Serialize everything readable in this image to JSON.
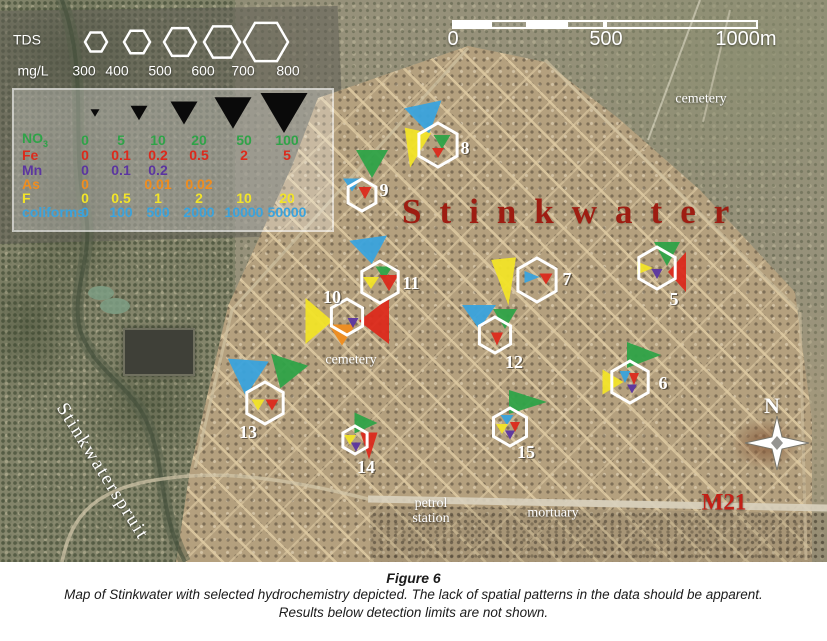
{
  "figure": {
    "label": "Figure 6",
    "caption1": "Map of Stinkwater with selected hydrochemistry depicted. The lack of spatial patterns in the data should be apparent.",
    "caption2": "Results below detection limits are not shown."
  },
  "map": {
    "title": "Stinkwater",
    "title_color": "#9e1d12",
    "place_labels": [
      {
        "name": "label-cemetery-north",
        "text": "cemetery",
        "x": 701,
        "y": 99,
        "size": 14
      },
      {
        "name": "label-cemetery-central",
        "text": "cemetery",
        "x": 351,
        "y": 360,
        "size": 14
      },
      {
        "name": "label-petrol-station",
        "text": "petrol\nstation",
        "x": 431,
        "y": 511,
        "size": 14
      },
      {
        "name": "label-mortuary",
        "text": "mortuary",
        "x": 553,
        "y": 513,
        "size": 14
      },
      {
        "name": "label-road-m21",
        "text": "M21",
        "x": 724,
        "y": 503,
        "size": 23,
        "color": "#c32017",
        "bold": true
      },
      {
        "name": "label-stinkwaterspruit",
        "text": "Stinkwaterspruit",
        "x": 102,
        "y": 472,
        "size": 19,
        "rot": 58,
        "spacing": 2
      },
      {
        "name": "label-compass-n",
        "text": "N",
        "x": 772,
        "y": 406,
        "size": 22,
        "bold": true
      }
    ],
    "compass": {
      "x": 777,
      "y": 443
    }
  },
  "params": {
    "NO3": "#2fa348",
    "Fe": "#dc2a1c",
    "Mn": "#5b35a0",
    "As": "#ef8d1f",
    "F": "#f2e428",
    "coliforms": "#3aa3dd"
  },
  "tds_legend": {
    "title": "TDS",
    "unit": "mg/L",
    "values": [
      "300",
      "400",
      "500",
      "600",
      "700",
      "800"
    ],
    "value_x": [
      84,
      117,
      160,
      203,
      243,
      288
    ],
    "label_y": 71,
    "hex_y": 42,
    "hexes": [
      {
        "x": 96,
        "r": 11
      },
      {
        "x": 137,
        "r": 13
      },
      {
        "x": 180,
        "r": 16
      },
      {
        "x": 222,
        "r": 18
      },
      {
        "x": 266,
        "r": 22
      }
    ]
  },
  "param_legend": {
    "tri_y": 113,
    "triangles": [
      {
        "x": 95,
        "w": 9
      },
      {
        "x": 139,
        "w": 17
      },
      {
        "x": 184,
        "w": 27
      },
      {
        "x": 233,
        "w": 37
      },
      {
        "x": 284,
        "w": 47
      }
    ],
    "col_x": [
      85,
      121,
      158,
      199,
      244,
      287
    ],
    "label_x": 22,
    "rows": [
      {
        "name": "NO3",
        "label": "NO",
        "sub": "3",
        "y": 140,
        "values": [
          "0",
          "5",
          "10",
          "20",
          "50",
          "100"
        ]
      },
      {
        "name": "Fe",
        "label": "Fe",
        "sub": "",
        "y": 155,
        "values": [
          "0",
          "0.1",
          "0.2",
          "0.5",
          "2",
          "5"
        ]
      },
      {
        "name": "Mn",
        "label": "Mn",
        "sub": "",
        "y": 170,
        "values": [
          "0",
          "0.1",
          "0.2",
          "",
          "",
          ""
        ]
      },
      {
        "name": "As",
        "label": "As",
        "sub": "",
        "y": 184,
        "values": [
          "0",
          "",
          "0.01",
          "0.02",
          "",
          ""
        ]
      },
      {
        "name": "F",
        "label": "F",
        "sub": "",
        "y": 198,
        "values": [
          "0",
          "0.5",
          "1",
          "2",
          "10",
          "20"
        ]
      },
      {
        "name": "coliforms",
        "label": "coliforms",
        "sub": "",
        "y": 212,
        "values": [
          "0",
          "100",
          "500",
          "2000",
          "10000",
          "50000"
        ]
      }
    ]
  },
  "scalebar": {
    "x": 452,
    "y": 20,
    "h": 9,
    "segments": [
      {
        "w": 38,
        "filled": true
      },
      {
        "w": 38,
        "filled": false
      },
      {
        "w": 38,
        "filled": true
      },
      {
        "w": 39,
        "filled": false
      },
      {
        "w": 153,
        "filled": false
      }
    ],
    "labels": [
      {
        "text": "0",
        "x": 453
      },
      {
        "text": "500",
        "x": 606
      },
      {
        "text": "1000m",
        "x": 746
      }
    ],
    "label_y": 40
  },
  "sites": [
    {
      "id": "5",
      "x": 657,
      "y": 268,
      "r": 21,
      "num": {
        "dx": 17,
        "dy": 31
      },
      "triangles": [
        {
          "p": "NO3",
          "dir": "down",
          "w": 26,
          "h": 24,
          "dx": 10,
          "dy": -14,
          "rot": 0
        },
        {
          "p": "Fe",
          "dir": "left",
          "w": 18,
          "h": 40,
          "dx": 20,
          "dy": 4,
          "rot": 0
        },
        {
          "p": "F",
          "dir": "right",
          "w": 16,
          "h": 13,
          "dx": -12,
          "dy": 0,
          "rot": 0
        },
        {
          "p": "Mn",
          "dir": "down",
          "w": 11,
          "h": 10,
          "dx": 0,
          "dy": 6,
          "rot": 0
        }
      ]
    },
    {
      "id": "6",
      "x": 630,
      "y": 382,
      "r": 21,
      "num": {
        "dx": 33,
        "dy": 1
      },
      "triangles": [
        {
          "p": "NO3",
          "dir": "right",
          "w": 34,
          "h": 26,
          "dx": 14,
          "dy": -27,
          "rot": 0
        },
        {
          "p": "F",
          "dir": "right",
          "w": 21,
          "h": 25,
          "dx": -17,
          "dy": 0,
          "rot": 0
        },
        {
          "p": "coliforms",
          "dir": "down",
          "w": 11,
          "h": 12,
          "dx": -5,
          "dy": -5,
          "rot": 0
        },
        {
          "p": "Fe",
          "dir": "down",
          "w": 10,
          "h": 12,
          "dx": 4,
          "dy": -3,
          "rot": 0
        },
        {
          "p": "Mn",
          "dir": "down",
          "w": 10,
          "h": 9,
          "dx": 2,
          "dy": 7,
          "rot": 0
        }
      ]
    },
    {
      "id": "7",
      "x": 537,
      "y": 280,
      "r": 22,
      "num": {
        "dx": 30,
        "dy": -1
      },
      "triangles": [
        {
          "p": "F",
          "dir": "down",
          "w": 25,
          "h": 47,
          "dx": -31,
          "dy": 2,
          "rot": -6
        },
        {
          "p": "coliforms",
          "dir": "right",
          "w": 15,
          "h": 12,
          "dx": -5,
          "dy": -3,
          "rot": 0
        },
        {
          "p": "Fe",
          "dir": "down",
          "w": 13,
          "h": 11,
          "dx": 9,
          "dy": -1,
          "rot": 0
        }
      ]
    },
    {
      "id": "8",
      "x": 438,
      "y": 145,
      "r": 22,
      "num": {
        "dx": 27,
        "dy": 3
      },
      "triangles": [
        {
          "p": "coliforms",
          "dir": "down",
          "w": 38,
          "h": 30,
          "dx": -12,
          "dy": -26,
          "rot": -12
        },
        {
          "p": "F",
          "dir": "down",
          "w": 27,
          "h": 38,
          "dx": -24,
          "dy": 4,
          "rot": 12
        },
        {
          "p": "NO3",
          "dir": "down",
          "w": 17,
          "h": 14,
          "dx": 4,
          "dy": -3,
          "rot": 0
        },
        {
          "p": "Fe",
          "dir": "down",
          "w": 12,
          "h": 10,
          "dx": 0,
          "dy": 8,
          "rot": 0
        }
      ]
    },
    {
      "id": "9",
      "x": 362,
      "y": 195,
      "r": 16,
      "num": {
        "dx": 22,
        "dy": -5
      },
      "triangles": [
        {
          "p": "NO3",
          "dir": "down",
          "w": 32,
          "h": 28,
          "dx": 10,
          "dy": -31,
          "rot": 0
        },
        {
          "p": "coliforms",
          "dir": "down",
          "w": 18,
          "h": 13,
          "dx": -10,
          "dy": -10,
          "rot": 0
        },
        {
          "p": "Fe",
          "dir": "down",
          "w": 13,
          "h": 12,
          "dx": 3,
          "dy": -2,
          "rot": 0
        }
      ]
    },
    {
      "id": "10",
      "x": 347,
      "y": 317,
      "r": 18,
      "num": {
        "dx": -15,
        "dy": -20
      },
      "triangles": [
        {
          "p": "F",
          "dir": "right",
          "w": 27,
          "h": 46,
          "dx": -28,
          "dy": 4,
          "rot": 0
        },
        {
          "p": "Fe",
          "dir": "left",
          "w": 30,
          "h": 46,
          "dx": 27,
          "dy": 4,
          "rot": 0
        },
        {
          "p": "As",
          "dir": "down",
          "w": 27,
          "h": 21,
          "dx": -5,
          "dy": 18,
          "rot": 0
        },
        {
          "p": "Mn",
          "dir": "down",
          "w": 11,
          "h": 10,
          "dx": 6,
          "dy": 6,
          "rot": 0
        }
      ]
    },
    {
      "id": "11",
      "x": 380,
      "y": 282,
      "r": 21,
      "num": {
        "dx": 31,
        "dy": 1
      },
      "triangles": [
        {
          "p": "coliforms",
          "dir": "down",
          "w": 38,
          "h": 26,
          "dx": -10,
          "dy": -31,
          "rot": -8
        },
        {
          "p": "NO3",
          "dir": "down",
          "w": 17,
          "h": 13,
          "dx": 4,
          "dy": -9,
          "rot": 0
        },
        {
          "p": "F",
          "dir": "down",
          "w": 16,
          "h": 12,
          "dx": -9,
          "dy": 1,
          "rot": 0
        },
        {
          "p": "Fe",
          "dir": "down",
          "w": 19,
          "h": 16,
          "dx": 9,
          "dy": 1,
          "rot": 0
        }
      ]
    },
    {
      "id": "12",
      "x": 495,
      "y": 335,
      "r": 18,
      "num": {
        "dx": 19,
        "dy": 27
      },
      "triangles": [
        {
          "p": "coliforms",
          "dir": "down",
          "w": 34,
          "h": 24,
          "dx": -16,
          "dy": -18,
          "rot": 0
        },
        {
          "p": "NO3",
          "dir": "down",
          "w": 24,
          "h": 20,
          "dx": 10,
          "dy": -16,
          "rot": 0
        },
        {
          "p": "Fe",
          "dir": "down",
          "w": 12,
          "h": 13,
          "dx": 2,
          "dy": 4,
          "rot": 0
        }
      ]
    },
    {
      "id": "13",
      "x": 265,
      "y": 403,
      "r": 21,
      "num": {
        "dx": -17,
        "dy": 29
      },
      "triangles": [
        {
          "p": "coliforms",
          "dir": "down",
          "w": 41,
          "h": 36,
          "dx": -18,
          "dy": -25,
          "rot": 4
        },
        {
          "p": "NO3",
          "dir": "down",
          "w": 39,
          "h": 30,
          "dx": 20,
          "dy": -29,
          "rot": 18
        },
        {
          "p": "F",
          "dir": "down",
          "w": 13,
          "h": 11,
          "dx": -7,
          "dy": 2,
          "rot": 0
        },
        {
          "p": "Fe",
          "dir": "down",
          "w": 13,
          "h": 11,
          "dx": 7,
          "dy": 2,
          "rot": 0
        }
      ]
    },
    {
      "id": "14",
      "x": 355,
      "y": 440,
      "r": 14,
      "num": {
        "dx": 11,
        "dy": 27
      },
      "triangles": [
        {
          "p": "NO3",
          "dir": "right",
          "w": 23,
          "h": 21,
          "dx": 11,
          "dy": -17,
          "rot": 0
        },
        {
          "p": "Fe",
          "dir": "down",
          "w": 17,
          "h": 27,
          "dx": 14,
          "dy": 6,
          "rot": 0
        },
        {
          "p": "F",
          "dir": "down",
          "w": 12,
          "h": 10,
          "dx": -5,
          "dy": 0,
          "rot": 0
        },
        {
          "p": "Mn",
          "dir": "down",
          "w": 10,
          "h": 9,
          "dx": 1,
          "dy": 7,
          "rot": 0
        }
      ]
    },
    {
      "id": "15",
      "x": 510,
      "y": 427,
      "r": 19,
      "num": {
        "dx": 16,
        "dy": 25
      },
      "triangles": [
        {
          "p": "NO3",
          "dir": "right",
          "w": 38,
          "h": 24,
          "dx": 18,
          "dy": -25,
          "rot": 0
        },
        {
          "p": "coliforms",
          "dir": "down",
          "w": 13,
          "h": 10,
          "dx": -3,
          "dy": -7,
          "rot": 0
        },
        {
          "p": "F",
          "dir": "down",
          "w": 12,
          "h": 10,
          "dx": -8,
          "dy": 2,
          "rot": 0
        },
        {
          "p": "Fe",
          "dir": "down",
          "w": 10,
          "h": 10,
          "dx": 5,
          "dy": 0,
          "rot": 0
        },
        {
          "p": "Mn",
          "dir": "down",
          "w": 10,
          "h": 9,
          "dx": 0,
          "dy": 8,
          "rot": 0
        }
      ]
    }
  ]
}
